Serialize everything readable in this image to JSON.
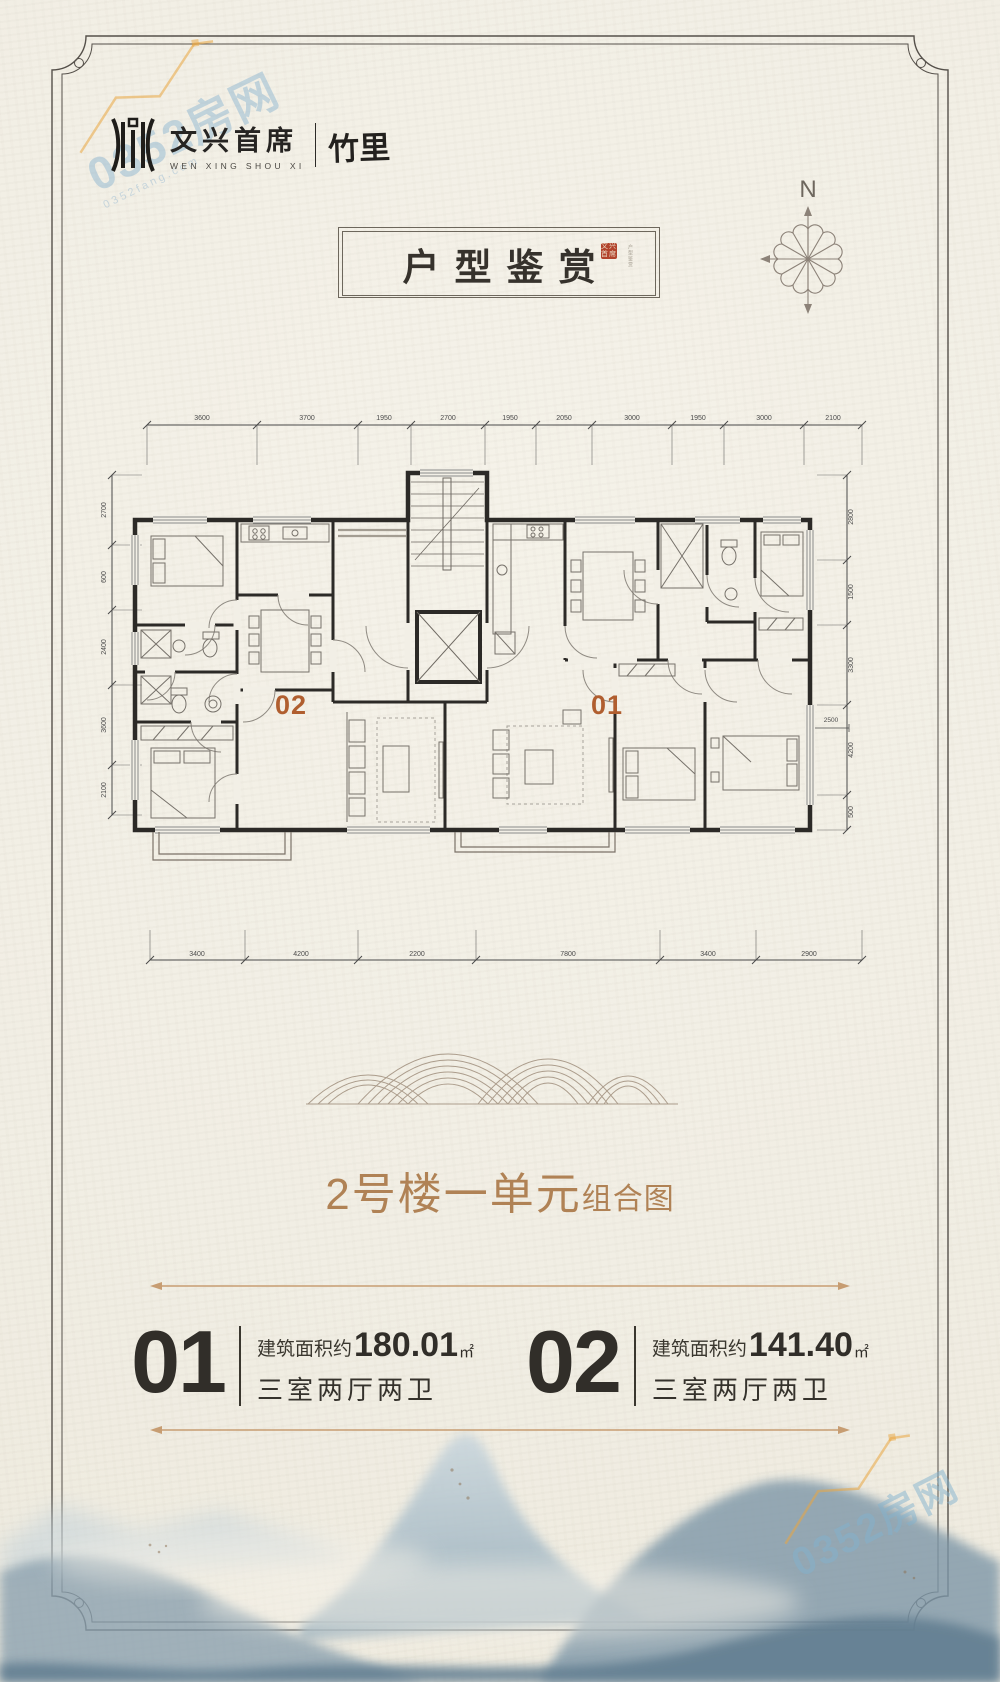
{
  "watermark_tl": {
    "text": "0352房网",
    "sub": "0352fang.com"
  },
  "watermark_br": {
    "text": "0352房网"
  },
  "logo": {
    "cn": "文兴首席",
    "en": "WEN XING SHOU XI",
    "name": "竹里"
  },
  "plaque": {
    "title": "户型鉴赏",
    "seal": "文兴首席",
    "seal_side": "户型鉴赏"
  },
  "compass": {
    "north": "N"
  },
  "plan": {
    "unit01_label": "01",
    "unit02_label": "02",
    "inner_dim": "2500",
    "dims_top": [
      "3600",
      "3700",
      "1950",
      "2700",
      "1950",
      "2050",
      "3000",
      "1950",
      "3000",
      "2100"
    ],
    "dims_bottom": [
      "3400",
      "4200",
      "2200",
      "7800",
      "3400",
      "2900"
    ],
    "dims_left": [
      "2700",
      "600",
      "2400",
      "3600",
      "2100"
    ],
    "dims_right": [
      "2800",
      "1500",
      "3300",
      "4200",
      "500"
    ]
  },
  "caption": {
    "main": "2号楼一单元",
    "sub": "组合图"
  },
  "units": [
    {
      "no": "01",
      "area_prefix": "建筑面积约",
      "area": "180.01",
      "unit": "㎡",
      "rooms": "三室两厅两卫"
    },
    {
      "no": "02",
      "area_prefix": "建筑面积约",
      "area": "141.40",
      "unit": "㎡",
      "rooms": "三室两厅两卫"
    }
  ]
}
